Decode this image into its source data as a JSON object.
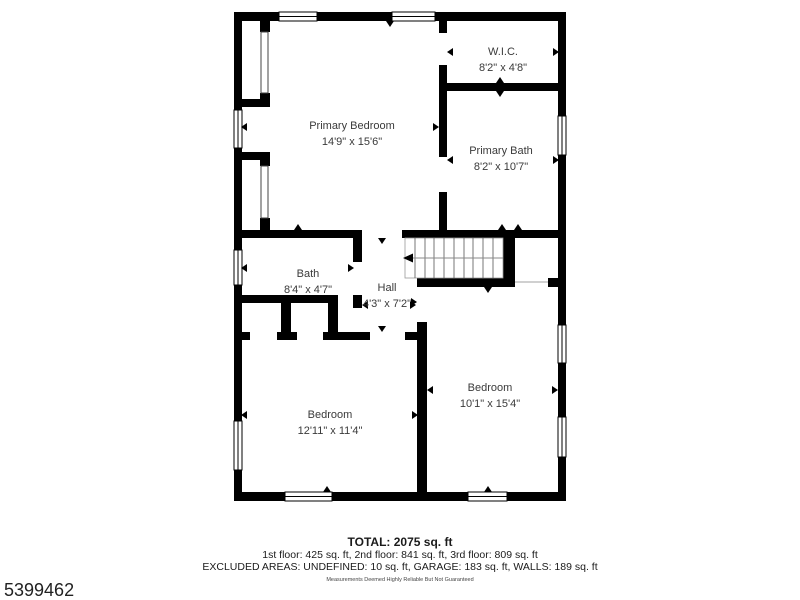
{
  "rooms": {
    "primary_bedroom": {
      "name": "Primary Bedroom",
      "dims": "14'9\" x 15'6\""
    },
    "wic": {
      "name": "W.I.C.",
      "dims": "8'2\" x 4'8\""
    },
    "primary_bath": {
      "name": "Primary Bath",
      "dims": "8'2\" x 10'7\""
    },
    "bath": {
      "name": "Bath",
      "dims": "8'4\" x 4'7\""
    },
    "hall": {
      "name": "Hall",
      "dims": "4'3\" x 7'2\""
    },
    "bedroom_left": {
      "name": "Bedroom",
      "dims": "12'11\" x 11'4\""
    },
    "bedroom_right": {
      "name": "Bedroom",
      "dims": "10'1\" x 15'4\""
    }
  },
  "footer": {
    "total": "TOTAL: 2075 sq. ft",
    "floors": "1st floor: 425 sq. ft, 2nd floor: 841 sq. ft, 3rd floor: 809 sq. ft",
    "excluded": "EXCLUDED AREAS: UNDEFINED: 10 sq. ft, GARAGE: 183 sq. ft, WALLS: 189 sq. ft",
    "disclaimer": "Measurements Deemed Highly Reliable But Not Guaranteed"
  },
  "listing_id": "5399462",
  "colors": {
    "walls": "#000000",
    "room_label_text": "#3a3a3a",
    "footer_text": "#1b1b1b",
    "background": "#ffffff"
  }
}
